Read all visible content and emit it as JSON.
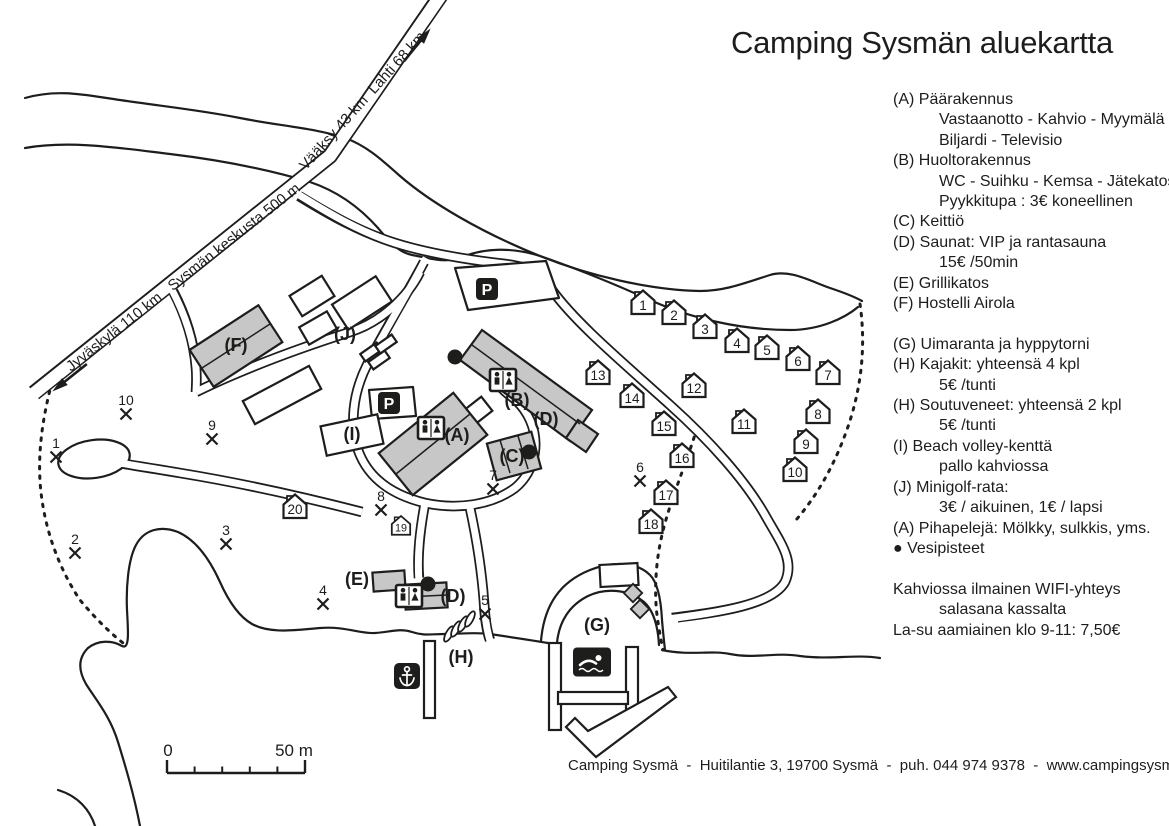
{
  "title": "Camping Sysmän aluekartta",
  "footer": "Camping Sysmä  -  Huitilantie 3, 19700 Sysmä  -  puh. 044 974 9378  -  www.campingsysma.fi",
  "colors": {
    "ink": "#1d1d1b",
    "building_fill": "#c7c7c7",
    "background": "#ffffff"
  },
  "scale": {
    "zero": "0",
    "max": "50 m"
  },
  "road_labels": [
    {
      "text": "Jyväskylä 110 km   Sysmän keskusta 500 m",
      "x": 186,
      "y": 281,
      "angle": -38.3,
      "size": 15
    },
    {
      "text": "Vääksy 43 km  Lahti 68 km",
      "x": 366,
      "y": 104,
      "angle": -48,
      "size": 15
    }
  ],
  "legend": [
    {
      "text": "(A) Päärakennus",
      "indent": 0
    },
    {
      "text": "Vastaanotto - Kahvio - Myymälä",
      "indent": 1
    },
    {
      "text": "Biljardi - Televisio",
      "indent": 1
    },
    {
      "text": "(B) Huoltorakennus",
      "indent": 0
    },
    {
      "text": "WC - Suihku - Kemsa - Jätekatos",
      "indent": 1
    },
    {
      "text": "Pyykkitupa : 3€ koneellinen",
      "indent": 1
    },
    {
      "text": "(C) Keittiö",
      "indent": 0
    },
    {
      "text": "(D) Saunat: VIP ja rantasauna",
      "indent": 0
    },
    {
      "text": "15€ /50min",
      "indent": 1
    },
    {
      "text": "(E) Grillikatos",
      "indent": 0
    },
    {
      "text": "(F) Hostelli Airola",
      "indent": 0
    },
    {
      "text": "",
      "indent": 0
    },
    {
      "text": "(G) Uimaranta ja hyppytorni",
      "indent": 0
    },
    {
      "text": "(H) Kajakit: yhteensä 4 kpl",
      "indent": 0
    },
    {
      "text": "5€ /tunti",
      "indent": 1
    },
    {
      "text": "(H) Soutuveneet: yhteensä 2 kpl",
      "indent": 0
    },
    {
      "text": "5€ /tunti",
      "indent": 1
    },
    {
      "text": "(I) Beach volley-kenttä",
      "indent": 0
    },
    {
      "text": "pallo kahviossa",
      "indent": 1
    },
    {
      "text": "(J) Minigolf-rata:",
      "indent": 0
    },
    {
      "text": "3€ / aikuinen, 1€ / lapsi",
      "indent": 1
    },
    {
      "text": "(A) Pihapelejä: Mölkky, sulkkis, yms.",
      "indent": 0
    },
    {
      "text": "● Vesipisteet",
      "indent": 0
    },
    {
      "text": "",
      "indent": 0
    },
    {
      "text": "Kahviossa ilmainen WIFI-yhteys",
      "indent": 0
    },
    {
      "text": "salasana kassalta",
      "indent": 1
    },
    {
      "text": "La-su aamiainen klo 9-11: 7,50€",
      "indent": 0
    }
  ],
  "map": {
    "parking_symbol": "P",
    "area_labels": [
      {
        "t": "(J)",
        "x": 345,
        "y": 340
      },
      {
        "t": "(F)",
        "x": 236,
        "y": 351
      },
      {
        "t": "(I)",
        "x": 352,
        "y": 440
      },
      {
        "t": "(A)",
        "x": 457,
        "y": 441
      },
      {
        "t": "(B)",
        "x": 517,
        "y": 406
      },
      {
        "t": "(D)",
        "x": 546,
        "y": 425
      },
      {
        "t": "(C)",
        "x": 512,
        "y": 462
      },
      {
        "t": "(E)",
        "x": 357,
        "y": 585
      },
      {
        "t": "(D)",
        "x": 453,
        "y": 602
      },
      {
        "t": "(H)",
        "x": 461,
        "y": 663
      },
      {
        "t": "(G)",
        "x": 597,
        "y": 631
      }
    ],
    "huts": [
      {
        "n": "1",
        "x": 643,
        "y": 303
      },
      {
        "n": "2",
        "x": 674,
        "y": 313
      },
      {
        "n": "3",
        "x": 705,
        "y": 327
      },
      {
        "n": "4",
        "x": 737,
        "y": 341
      },
      {
        "n": "5",
        "x": 767,
        "y": 348
      },
      {
        "n": "6",
        "x": 798,
        "y": 359
      },
      {
        "n": "7",
        "x": 828,
        "y": 373
      },
      {
        "n": "8",
        "x": 818,
        "y": 412
      },
      {
        "n": "9",
        "x": 806,
        "y": 442
      },
      {
        "n": "10",
        "x": 795,
        "y": 470
      },
      {
        "n": "11",
        "x": 744,
        "y": 422
      },
      {
        "n": "12",
        "x": 694,
        "y": 386
      },
      {
        "n": "13",
        "x": 598,
        "y": 373
      },
      {
        "n": "14",
        "x": 632,
        "y": 396
      },
      {
        "n": "15",
        "x": 664,
        "y": 424
      },
      {
        "n": "16",
        "x": 682,
        "y": 456
      },
      {
        "n": "17",
        "x": 666,
        "y": 493
      },
      {
        "n": "18",
        "x": 651,
        "y": 522
      },
      {
        "n": "19",
        "x": 401,
        "y": 526,
        "s": 0.8
      },
      {
        "n": "20",
        "x": 295,
        "y": 507
      }
    ],
    "pitches": [
      {
        "n": "1",
        "x": 56,
        "y": 456
      },
      {
        "n": "2",
        "x": 75,
        "y": 552
      },
      {
        "n": "3",
        "x": 226,
        "y": 543
      },
      {
        "n": "4",
        "x": 323,
        "y": 603
      },
      {
        "n": "5",
        "x": 485,
        "y": 613
      },
      {
        "n": "6",
        "x": 640,
        "y": 480
      },
      {
        "n": "7",
        "x": 493,
        "y": 488
      },
      {
        "n": "8",
        "x": 381,
        "y": 509
      },
      {
        "n": "9",
        "x": 212,
        "y": 438
      },
      {
        "n": "10",
        "x": 126,
        "y": 413
      }
    ],
    "water_points": [
      {
        "x": 455,
        "y": 357
      },
      {
        "x": 529,
        "y": 452
      },
      {
        "x": 428,
        "y": 584
      }
    ],
    "parking": [
      {
        "x": 487,
        "y": 289
      },
      {
        "x": 389,
        "y": 403
      }
    ],
    "wc": [
      {
        "x": 431,
        "y": 428
      },
      {
        "x": 503,
        "y": 380
      },
      {
        "x": 409,
        "y": 596
      }
    ]
  }
}
